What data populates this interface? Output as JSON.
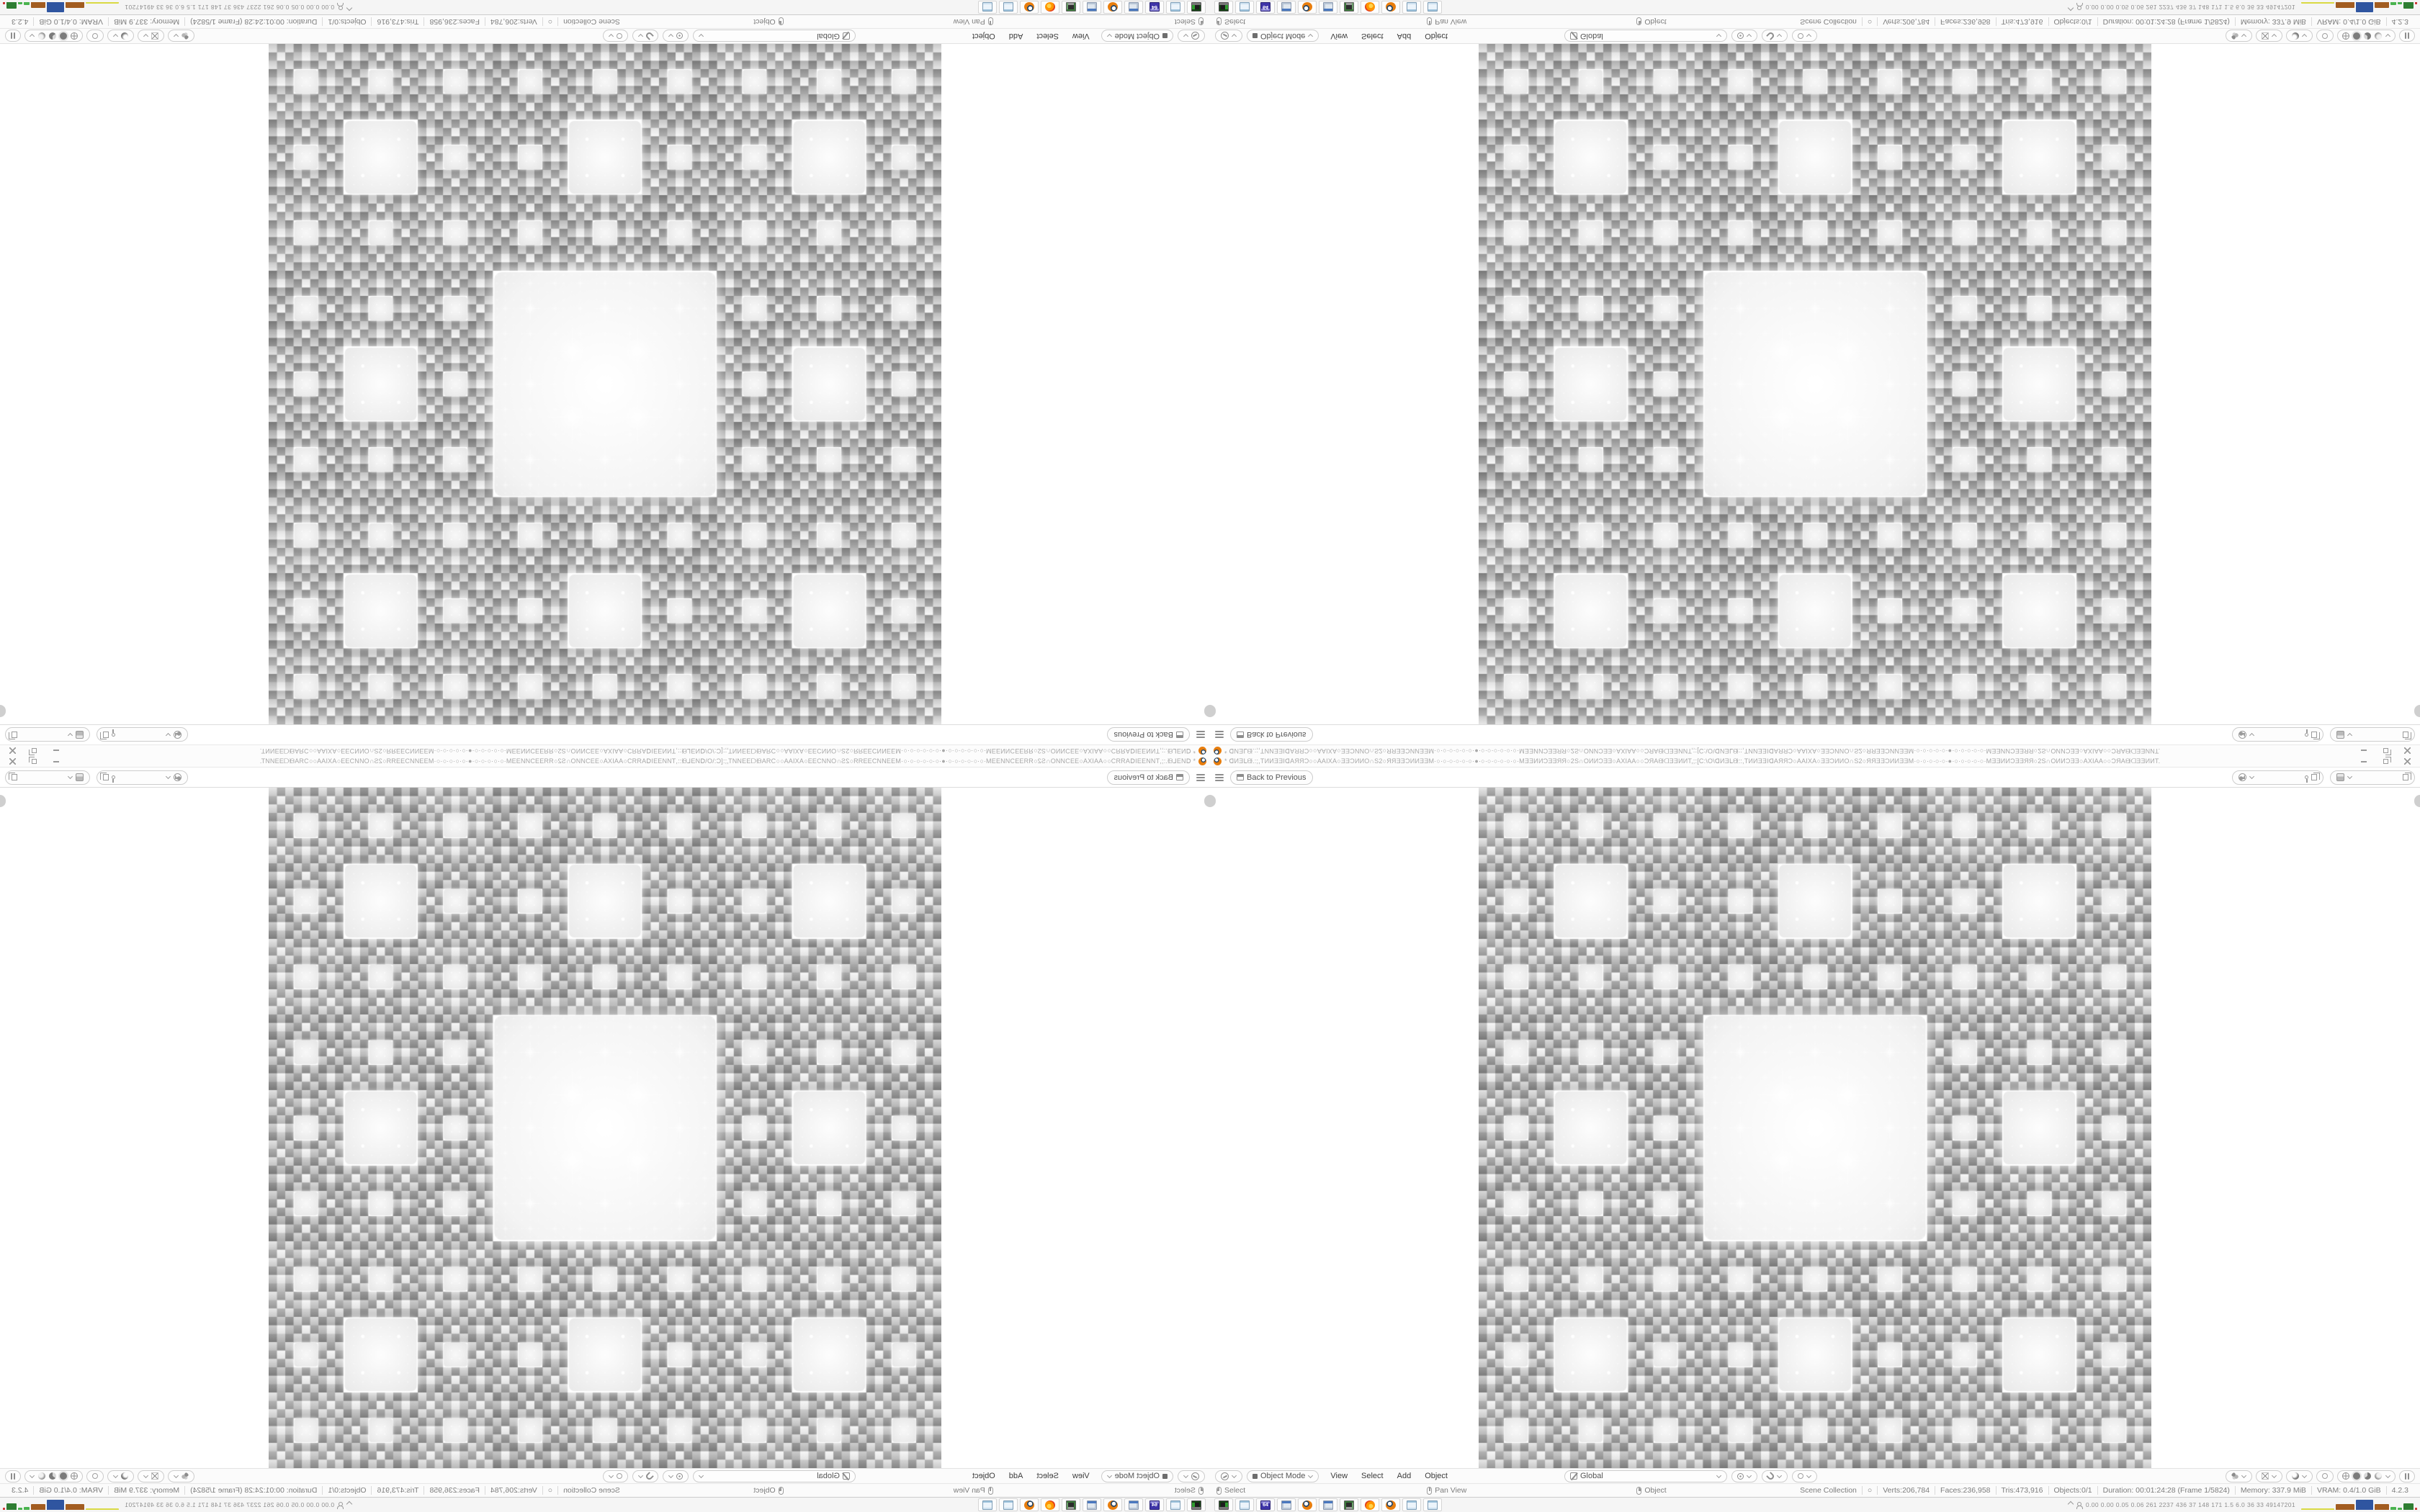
{
  "window": {
    "title": "* ᗡИƎᒪᙠ.:;,TИИƎƎIᗡAЯЯƆ○○AAIXA○ƎƎƆИИO∩S2○ЯЯƎƎƆИИƎƎM·○·○·○·○·○·○·●·○·○·○·○·○·○·MƎƎИИƆƎƎЯЯ○2S∩OИИƆƎƎ○AXIAA○○ƆЯAᙠᗡƎƎИИT,;:[C:\\O\\ᗡИƎᒪᙠ::,TИИƎƎIᗡAЯЯƆ○AAIXA○ƎƎƆИИO∩S2○ЯЯƎƎƆИИƎƎM·○·○·○·○·○·●·○·○·○·○·○·MƎƎИИƆƎƎЯЯ○2S∩OИИƆƎƎ○AXIAA○○ƆЯAᙠᗡƎƎИИT."
  },
  "topbar": {
    "back_label": "Back to Previous",
    "scene_name": "",
    "view_layer_name": ""
  },
  "viewport": {
    "header": {
      "mode": "Object Mode",
      "menus": [
        "View",
        "Select",
        "Add",
        "Object"
      ],
      "orientation": "Global"
    },
    "fractal": {
      "grid": 81,
      "note": "Sierpinski-carpet style render, white glowing squares on gray plaid"
    }
  },
  "status": {
    "hints": [
      {
        "name": "select",
        "icon": "mouse-left",
        "label": "Select"
      },
      {
        "name": "pan-view",
        "icon": "mouse-middle",
        "label": "Pan View"
      },
      {
        "name": "object",
        "icon": "mouse-right",
        "label": "Object"
      }
    ],
    "stats": [
      "Scene Collection",
      "○",
      "Verts:206,784",
      "Faces:236,958",
      "Tris:473,916",
      "Objects:0/1",
      "Duration: 00:01:24:28 (Frame 1/5824)",
      "Memory: 337.9 MiB",
      "VRAM: 0.4/1.0 GiB",
      "4.2.3"
    ]
  },
  "taskbar": {
    "items": [
      {
        "name": "console",
        "icon": "console",
        "label": ""
      },
      {
        "name": "notepad",
        "icon": "notepad",
        "label": ""
      },
      {
        "name": "emulator-64",
        "icon": "floppy",
        "label": "64"
      },
      {
        "name": "calculator",
        "icon": "calc",
        "label": ""
      },
      {
        "name": "blender",
        "icon": "blender",
        "label": ""
      },
      {
        "name": "calculator-2",
        "icon": "calc",
        "label": ""
      },
      {
        "name": "display",
        "icon": "monitor",
        "label": ""
      },
      {
        "name": "firefox",
        "icon": "firefox",
        "label": ""
      },
      {
        "name": "blender-2",
        "icon": "blender",
        "label": ""
      },
      {
        "name": "notepad-2",
        "icon": "notepad",
        "label": ""
      },
      {
        "name": "notepad-3",
        "icon": "notepad",
        "label": ""
      }
    ],
    "tray_text": "0.00 0.00 0.05 0.06 261 2237 436 37 148 171 1.5 6.0 36 33 49147201",
    "tray_bars": [
      {
        "c": "#d9d943",
        "w": 46,
        "h": 2
      },
      {
        "c": "#a25c20",
        "w": 26,
        "h": 8
      },
      {
        "c": "#2f55a0",
        "w": 24,
        "h": 14
      },
      {
        "c": "#a25c20",
        "w": 20,
        "h": 8
      },
      {
        "c": "#49b34e",
        "w": 8,
        "h": 4
      },
      {
        "c": "#49b34e",
        "w": 6,
        "h": 3
      },
      {
        "c": "#2e7d32",
        "w": 14,
        "h": 9
      },
      {
        "c": "#cc3333",
        "w": 3,
        "h": 3
      }
    ]
  },
  "colors": {
    "accent_orange": "#e87d0d",
    "plaid_dark": "#8e8e8e",
    "plaid_light": "#c6c6c6",
    "glow_white": "#ffffff"
  }
}
